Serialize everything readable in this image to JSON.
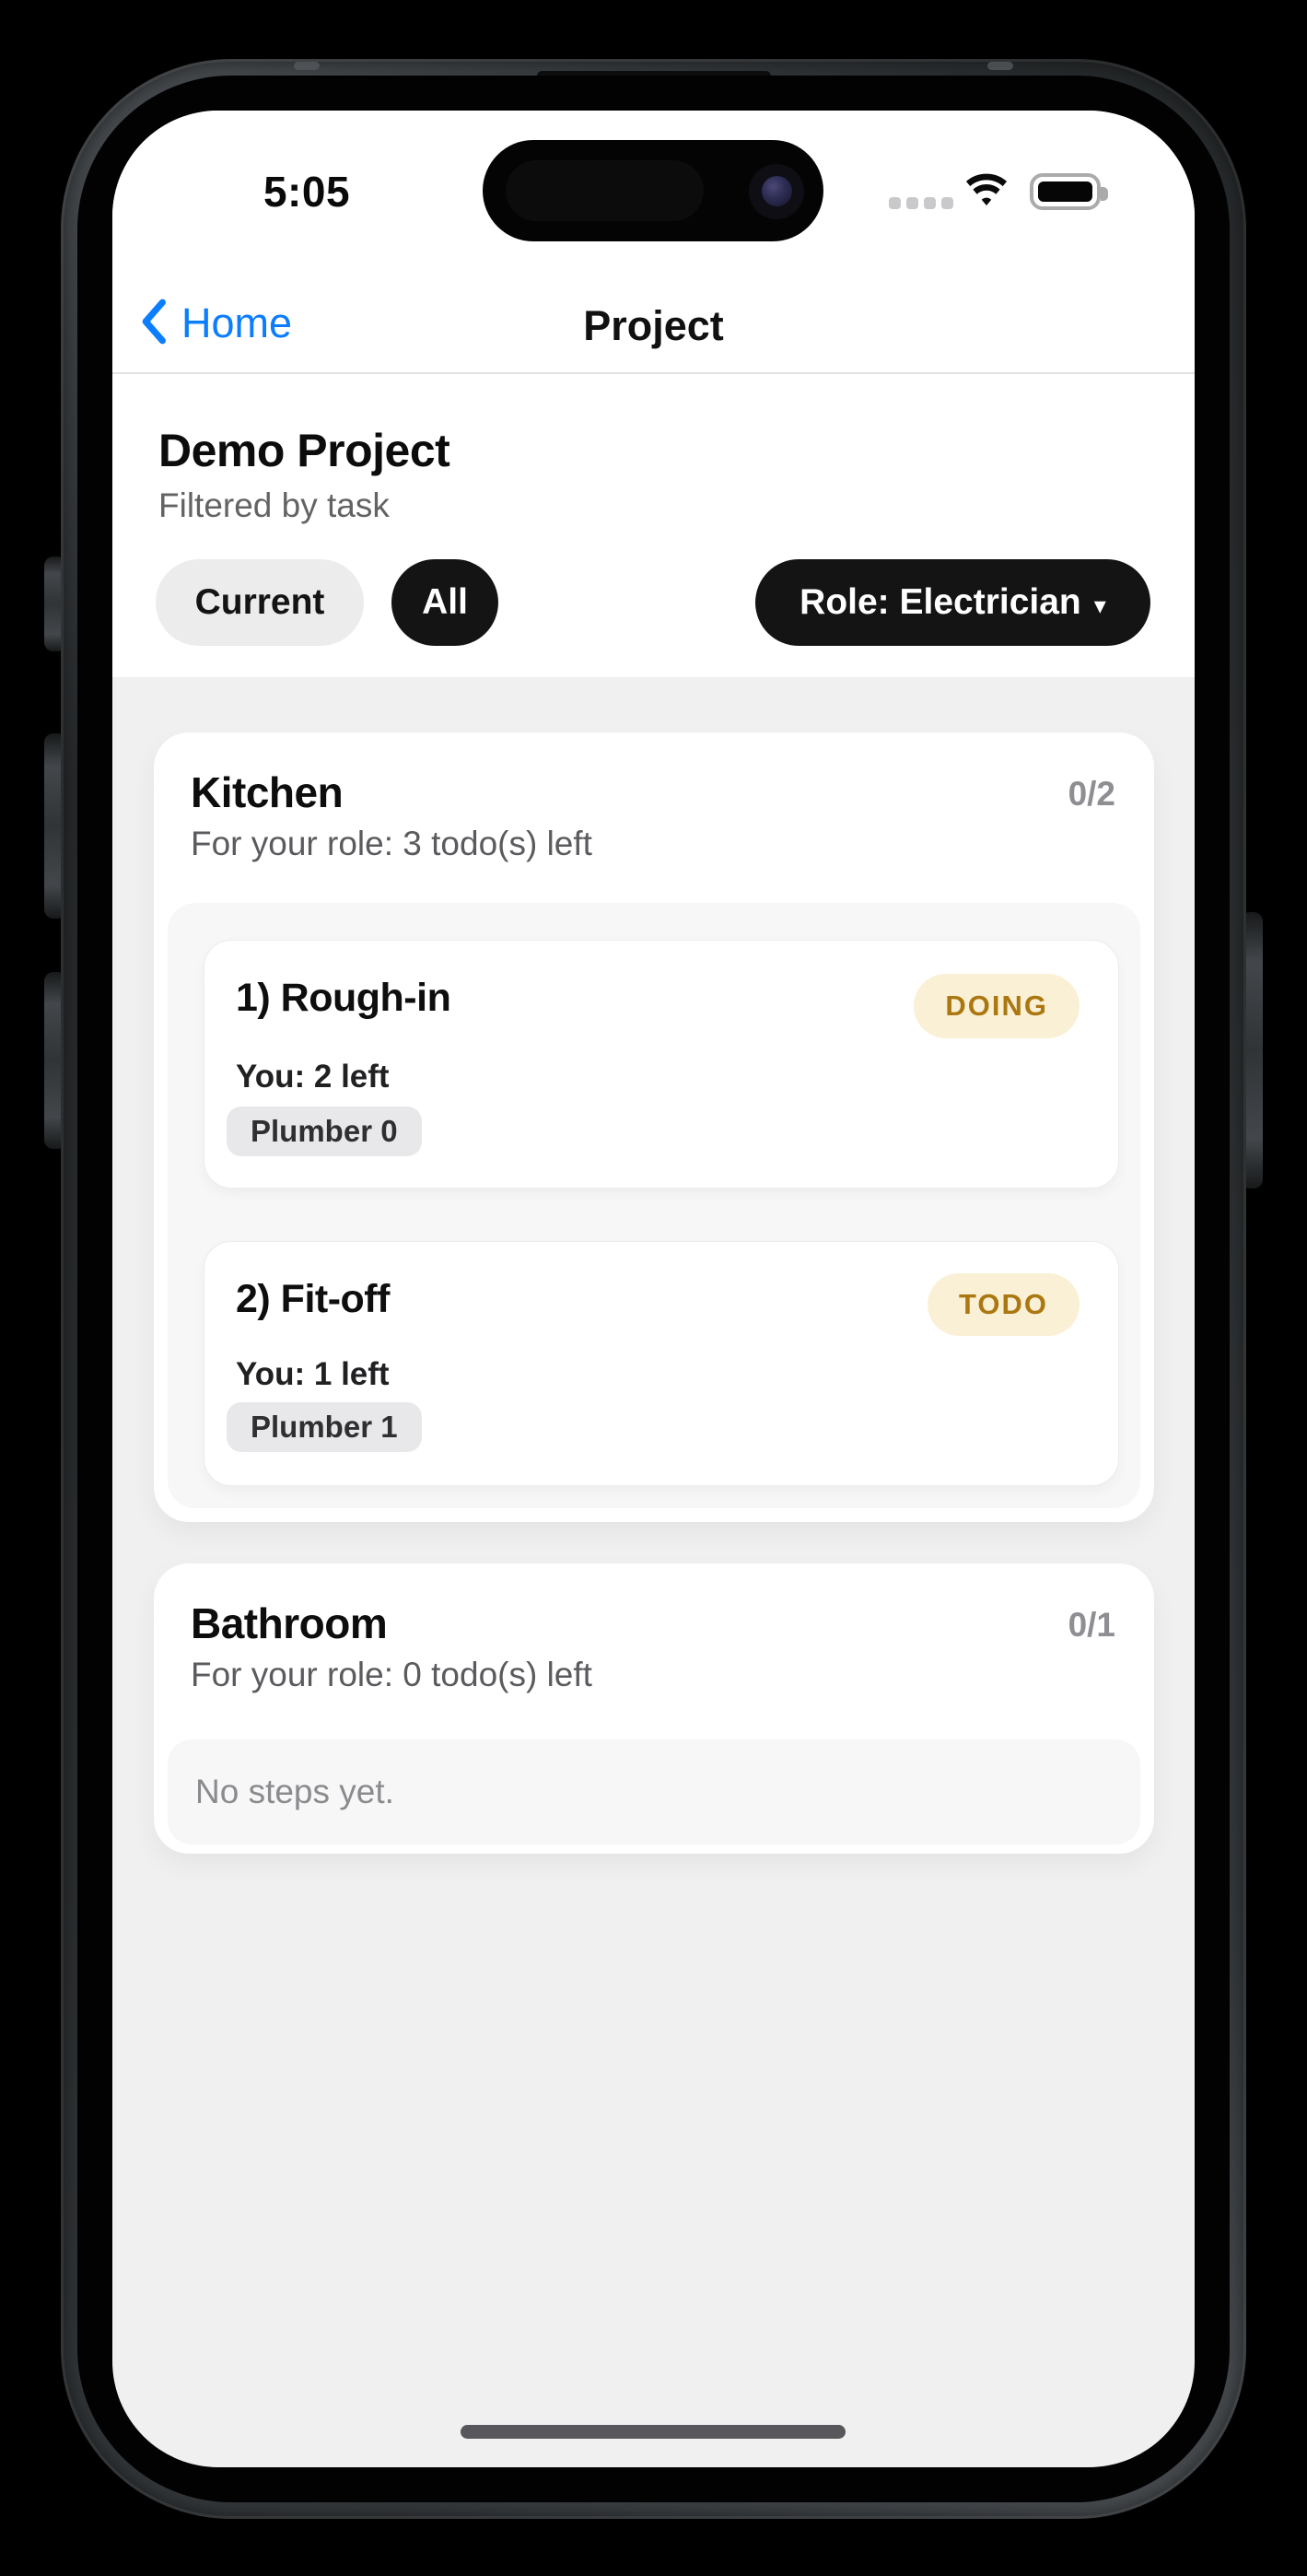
{
  "status_bar": {
    "time": "5:05",
    "cellular_icon": "cellular-signal-dots",
    "wifi_icon": "wifi-full",
    "battery_icon": "battery-full"
  },
  "nav": {
    "back_label": "Home",
    "title": "Project"
  },
  "header": {
    "title": "Demo Project",
    "subtitle": "Filtered by task"
  },
  "filters": {
    "current_label": "Current",
    "all_label": "All",
    "role_label": "Role: Electrician",
    "role_caret": "▾"
  },
  "sections": [
    {
      "title": "Kitchen",
      "progress": "0/2",
      "role_line": "For your role: 3 todo(s) left",
      "steps": [
        {
          "title": "1) Rough-in",
          "status": "DOING",
          "you_line": "You: 2 left",
          "role_chip": "Plumber 0"
        },
        {
          "title": "2) Fit-off",
          "status": "TODO",
          "you_line": "You: 1 left",
          "role_chip": "Plumber 1"
        }
      ]
    },
    {
      "title": "Bathroom",
      "progress": "0/1",
      "role_line": "For your role: 0 todo(s) left",
      "empty_text": "No steps yet."
    }
  ],
  "colors": {
    "accent_blue": "#0b7dff",
    "status_badge_bg": "#faf0d6",
    "status_badge_text": "#ab7710",
    "page_bg": "#f0f0f0",
    "panel_bg": "#f7f7f8",
    "chip_bg": "#e8e8ea",
    "dark_chip_bg": "#141415"
  }
}
